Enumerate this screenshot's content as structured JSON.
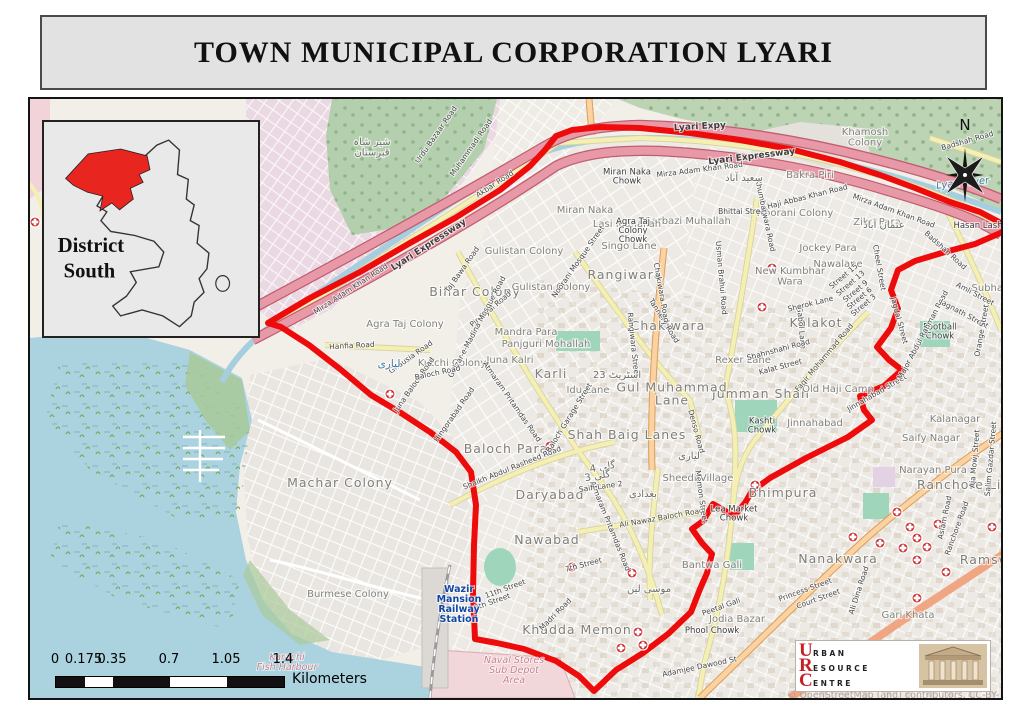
{
  "page": {
    "title": "TOWN MUNICIPAL CORPORATION LYARI"
  },
  "inset": {
    "label_line1": "District",
    "label_line2": "South"
  },
  "compass": {
    "label": "N"
  },
  "scalebar": {
    "ticks": [
      "0",
      "0.175",
      "0.35",
      "0.7",
      "1.05",
      "1.4"
    ],
    "unit": "Kilometers"
  },
  "attribution": "© OpenStreetMap (and) contributors, CC-BY-SA",
  "logo": {
    "letters": [
      "U",
      "R",
      "C"
    ],
    "words": [
      "RBAN",
      "ESOURCE",
      "ENTRE"
    ]
  },
  "colors": {
    "boundary_red": "#ee0b0b",
    "inset_highlight": "#e8251f",
    "water": "#aad3df",
    "expressway_fill": "#e899a7",
    "expressway_casing": "#c05e70",
    "road_yellow": "#f4efb2",
    "road_orange": "#fbd2a0",
    "poi_red": "#c8171c"
  },
  "map": {
    "labels": [
      {
        "t": "Miran Naka",
        "x": 585,
        "y": 213,
        "k": "a"
      },
      {
        "t": "Bihar Colony",
        "x": 475,
        "y": 296,
        "k": "A"
      },
      {
        "t": "Agra Taj Colony",
        "x": 405,
        "y": 327,
        "k": "a"
      },
      {
        "t": "Gulistan Colony",
        "x": 524,
        "y": 254,
        "k": "a"
      },
      {
        "t": "Gulistan Colony",
        "x": 551,
        "y": 290,
        "k": "a"
      },
      {
        "t": "Rangiwara",
        "x": 625,
        "y": 279,
        "k": "A"
      },
      {
        "t": "Chakiwara",
        "x": 668,
        "y": 330,
        "k": "A"
      },
      {
        "t": "Mandra Para",
        "x": 526,
        "y": 335,
        "k": "a"
      },
      {
        "t": "Panjguri Mohallah",
        "x": 546,
        "y": 347,
        "k": "a"
      },
      {
        "t": "Juna Kalri",
        "x": 510,
        "y": 363,
        "k": "a"
      },
      {
        "t": "Karli",
        "x": 551,
        "y": 378,
        "k": "A"
      },
      {
        "t": "Kutchi Colony",
        "x": 452,
        "y": 366,
        "k": "a"
      },
      {
        "t": "Singo Lane",
        "x": 629,
        "y": 249,
        "k": "a"
      },
      {
        "t": "Sarbazi Muhallah",
        "x": 688,
        "y": 224,
        "k": "a"
      },
      {
        "t": "Lasi Muhallah",
        "x": 627,
        "y": 227,
        "k": "a"
      },
      {
        "t": "Noorani Colony",
        "x": 795,
        "y": 216,
        "k": "a"
      },
      {
        "t": "Bakra Piri",
        "x": 810,
        "y": 178,
        "k": "a"
      },
      {
        "t": "Khamosh Colony",
        "x": 865,
        "y": 140,
        "k": "a",
        "lines": [
          "Khamosh",
          "Colony"
        ]
      },
      {
        "t": "Zikri Para",
        "x": 877,
        "y": 225,
        "k": "a"
      },
      {
        "t": "Jockey Para",
        "x": 828,
        "y": 251,
        "k": "a"
      },
      {
        "t": "Nawalane",
        "x": 838,
        "y": 267,
        "k": "a"
      },
      {
        "t": "New Kumbhar Wara",
        "x": 790,
        "y": 279,
        "k": "a",
        "lines": [
          "New Kumbhar",
          "Wara"
        ]
      },
      {
        "t": "Kalakot",
        "x": 816,
        "y": 327,
        "k": "A"
      },
      {
        "t": "Rexer Lane",
        "x": 743,
        "y": 363,
        "k": "a"
      },
      {
        "t": "Jumman Shah",
        "x": 761,
        "y": 398,
        "k": "A"
      },
      {
        "t": "Old Haji Camp",
        "x": 838,
        "y": 392,
        "k": "a"
      },
      {
        "t": "Gul Muhammad Lane",
        "x": 672,
        "y": 398,
        "k": "A",
        "lines": [
          "Gul Muhammad",
          "Lane"
        ]
      },
      {
        "t": "Shah Baig Lanes",
        "x": 627,
        "y": 439,
        "k": "A"
      },
      {
        "t": "Idu Lane",
        "x": 588,
        "y": 393,
        "k": "a"
      },
      {
        "t": "Baloch Para",
        "x": 506,
        "y": 453,
        "k": "A"
      },
      {
        "t": "Daryabad",
        "x": 550,
        "y": 499,
        "k": "A"
      },
      {
        "t": "Nawabad",
        "x": 547,
        "y": 544,
        "k": "A"
      },
      {
        "t": "Khadda Memon",
        "x": 577,
        "y": 634,
        "k": "A"
      },
      {
        "t": "Sheedi Village",
        "x": 698,
        "y": 481,
        "k": "a"
      },
      {
        "t": "Bhimpura",
        "x": 783,
        "y": 497,
        "k": "A"
      },
      {
        "t": "Bantwa Gali",
        "x": 712,
        "y": 568,
        "k": "a"
      },
      {
        "t": "Nanakwara",
        "x": 838,
        "y": 563,
        "k": "A"
      },
      {
        "t": "Saify Nagar",
        "x": 931,
        "y": 441,
        "k": "a"
      },
      {
        "t": "Kalanagar",
        "x": 955,
        "y": 422,
        "k": "a"
      },
      {
        "t": "Narayan Pura",
        "x": 933,
        "y": 473,
        "k": "a"
      },
      {
        "t": "Ranchore Line",
        "x": 968,
        "y": 489,
        "k": "A"
      },
      {
        "t": "Gari Khata",
        "x": 908,
        "y": 618,
        "k": "a"
      },
      {
        "t": "Jodia Bazar",
        "x": 737,
        "y": 622,
        "k": "a"
      },
      {
        "t": "Phool Chowk",
        "x": 712,
        "y": 633,
        "k": "c"
      },
      {
        "t": "Burmese Colony",
        "x": 348,
        "y": 597,
        "k": "a"
      },
      {
        "t": "Machar Colony",
        "x": 340,
        "y": 487,
        "k": "A"
      },
      {
        "t": "Subhash",
        "x": 993,
        "y": 291,
        "k": "a"
      },
      {
        "t": "Hasan Lash",
        "x": 978,
        "y": 228,
        "k": "c"
      },
      {
        "t": "Ramswami",
        "x": 998,
        "y": 564,
        "k": "A"
      },
      {
        "t": "Miran Naka Chowk",
        "x": 627,
        "y": 179,
        "k": "c",
        "lines": [
          "Miran Naka",
          "Chowk"
        ]
      },
      {
        "t": "Agra Taj Colony Chowk",
        "x": 633,
        "y": 233,
        "k": "c",
        "lines": [
          "Agra Taj",
          "Colony",
          "Chowk"
        ]
      },
      {
        "t": "Football Chowk",
        "x": 940,
        "y": 334,
        "k": "c",
        "lines": [
          "Football",
          "Chowk"
        ]
      },
      {
        "t": "Kashti Chowk",
        "x": 762,
        "y": 428,
        "k": "c",
        "lines": [
          "Kashti",
          "Chowk"
        ]
      },
      {
        "t": "Lea Market Chowk",
        "x": 734,
        "y": 516,
        "k": "c",
        "lines": [
          "Lea Market",
          "Chowk"
        ]
      },
      {
        "t": "Jinnahabad",
        "x": 815,
        "y": 426,
        "k": "a"
      },
      {
        "t": "Lyari Expy",
        "x": 700,
        "y": 129,
        "k": "R",
        "r": -3
      },
      {
        "t": "Lyari Expressway",
        "x": 752,
        "y": 159,
        "k": "R",
        "r": -7
      },
      {
        "t": "Mirza Adam Khan Road",
        "x": 700,
        "y": 172,
        "k": "r",
        "r": -7
      },
      {
        "t": "Mirza Adam Khan Road",
        "x": 893,
        "y": 213,
        "k": "r",
        "r": 20
      },
      {
        "t": "Mirza Adam Khan Road",
        "x": 352,
        "y": 291,
        "k": "r",
        "r": -33
      },
      {
        "t": "Lyari Expressway",
        "x": 430,
        "y": 247,
        "k": "R",
        "r": -33
      },
      {
        "t": "Akbar Road",
        "x": 496,
        "y": 186,
        "k": "r",
        "r": -33
      },
      {
        "t": "Muhammadi Road",
        "x": 473,
        "y": 149,
        "k": "r",
        "r": -55
      },
      {
        "t": "Urdu Bazaar Road",
        "x": 438,
        "y": 136,
        "k": "r",
        "r": -55
      },
      {
        "t": "Badshah Road",
        "x": 968,
        "y": 143,
        "k": "r",
        "r": -16
      },
      {
        "t": "Badshah Road",
        "x": 944,
        "y": 252,
        "k": "r",
        "r": 42
      },
      {
        "t": "Haji Abbas Khan Road",
        "x": 808,
        "y": 199,
        "k": "r",
        "r": -14
      },
      {
        "t": "Bhittai Street",
        "x": 743,
        "y": 214,
        "k": "r"
      },
      {
        "t": "Khumbarwara Road",
        "x": 763,
        "y": 216,
        "k": "r",
        "r": 78
      },
      {
        "t": "Tannery Road",
        "x": 662,
        "y": 322,
        "k": "r",
        "r": 58
      },
      {
        "t": "Chakiwara Road",
        "x": 659,
        "y": 293,
        "k": "r",
        "r": 80
      },
      {
        "t": "Rangiwara Street",
        "x": 631,
        "y": 345,
        "k": "r",
        "r": 84
      },
      {
        "t": "Denso Road",
        "x": 694,
        "y": 432,
        "k": "r",
        "r": 75
      },
      {
        "t": "Pir Siyal Road",
        "x": 492,
        "y": 311,
        "k": "r",
        "r": -40
      },
      {
        "t": "Gulzar-e-Madina Mosque Road",
        "x": 479,
        "y": 328,
        "k": "r",
        "r": -62
      },
      {
        "t": "Noorani Mosque Street",
        "x": 580,
        "y": 263,
        "k": "r",
        "r": -55
      },
      {
        "t": "Taj Bawa Road",
        "x": 464,
        "y": 271,
        "k": "r",
        "r": -55
      },
      {
        "t": "Ghausia Road",
        "x": 412,
        "y": 359,
        "k": "r",
        "r": -35
      },
      {
        "t": "Juna Baloch Road",
        "x": 416,
        "y": 386,
        "k": "r",
        "r": -55
      },
      {
        "t": "Baloch Road",
        "x": 438,
        "y": 375,
        "k": "r",
        "r": -12
      },
      {
        "t": "Hingorabad Road",
        "x": 456,
        "y": 416,
        "k": "r",
        "r": -55
      },
      {
        "t": "Atmaram Pritamdas Road",
        "x": 510,
        "y": 403,
        "k": "r",
        "r": 55
      },
      {
        "t": "Atmaram Pritamdas Road",
        "x": 608,
        "y": 527,
        "k": "r",
        "r": 68
      },
      {
        "t": "Shaikh Abdul Rasheed Road",
        "x": 513,
        "y": 470,
        "k": "r",
        "r": -22
      },
      {
        "t": "Ali Nawaz Baloch Road",
        "x": 662,
        "y": 520,
        "k": "r",
        "r": -10
      },
      {
        "t": "Baloch Garage Street",
        "x": 571,
        "y": 419,
        "k": "r",
        "r": -58
      },
      {
        "t": "Faqir Mohammad Road",
        "x": 826,
        "y": 359,
        "k": "r",
        "r": -50
      },
      {
        "t": "Gabol Lane",
        "x": 799,
        "y": 328,
        "k": "r",
        "r": 85
      },
      {
        "t": "Shahnshahi Road",
        "x": 779,
        "y": 352,
        "k": "r",
        "r": -15
      },
      {
        "t": "Kalat Street",
        "x": 781,
        "y": 369,
        "k": "r",
        "r": -15
      },
      {
        "t": "Jinnahabad Street",
        "x": 878,
        "y": 395,
        "k": "r",
        "r": -30
      },
      {
        "t": "Major Abdul Rahman Road",
        "x": 925,
        "y": 336,
        "k": "r",
        "r": -62
      },
      {
        "t": "Jagdal Street",
        "x": 897,
        "y": 321,
        "k": "r",
        "r": 75
      },
      {
        "t": "Cheel Street",
        "x": 877,
        "y": 268,
        "k": "r",
        "r": 80
      },
      {
        "t": "Jagnath Street",
        "x": 963,
        "y": 316,
        "k": "r",
        "r": 28
      },
      {
        "t": "Amli Street",
        "x": 974,
        "y": 296,
        "k": "r",
        "r": 28
      },
      {
        "t": "Orange Street",
        "x": 984,
        "y": 331,
        "k": "r",
        "r": -80
      },
      {
        "t": "Aslam Road",
        "x": 947,
        "y": 518,
        "k": "r",
        "r": -78
      },
      {
        "t": "Ranchore Road",
        "x": 959,
        "y": 529,
        "k": "r",
        "r": -70
      },
      {
        "t": "Aja Mowj Street",
        "x": 977,
        "y": 459,
        "k": "r",
        "r": -85
      },
      {
        "t": "Salim Gazdar Street",
        "x": 993,
        "y": 459,
        "k": "r",
        "r": -85
      },
      {
        "t": "Ali Dina Road",
        "x": 861,
        "y": 591,
        "k": "r",
        "r": -72
      },
      {
        "t": "Princess Street",
        "x": 806,
        "y": 592,
        "k": "r",
        "r": -20
      },
      {
        "t": "Court Street",
        "x": 819,
        "y": 601,
        "k": "r",
        "r": -20
      },
      {
        "t": "Adamjee Dawood St",
        "x": 700,
        "y": 669,
        "k": "r",
        "r": -12
      },
      {
        "t": "Peetal Gali",
        "x": 722,
        "y": 609,
        "k": "r",
        "r": -20
      },
      {
        "t": "Madri Road",
        "x": 557,
        "y": 616,
        "k": "r",
        "r": -45
      },
      {
        "t": "7th Street",
        "x": 584,
        "y": 567,
        "k": "r",
        "r": -15
      },
      {
        "t": "11th Street",
        "x": 506,
        "y": 591,
        "k": "r",
        "r": -20
      },
      {
        "t": "8th Street",
        "x": 493,
        "y": 604,
        "k": "r",
        "r": -20
      },
      {
        "t": "Street 15",
        "x": 845,
        "y": 278,
        "k": "r",
        "r": -40
      },
      {
        "t": "Street 13",
        "x": 852,
        "y": 285,
        "k": "r",
        "r": -40
      },
      {
        "t": "Street 9",
        "x": 857,
        "y": 293,
        "k": "r",
        "r": -40
      },
      {
        "t": "Street 6",
        "x": 861,
        "y": 300,
        "k": "r",
        "r": -40
      },
      {
        "t": "Street 3",
        "x": 865,
        "y": 307,
        "k": "r",
        "r": -40
      },
      {
        "t": "Sherok Lane",
        "x": 811,
        "y": 306,
        "k": "r",
        "r": -14
      },
      {
        "t": "Hanfia Road",
        "x": 352,
        "y": 348,
        "k": "r",
        "r": -3
      },
      {
        "t": "Saifi Lane 2",
        "x": 601,
        "y": 489,
        "k": "r",
        "r": -8
      },
      {
        "t": "Memon Street",
        "x": 699,
        "y": 497,
        "k": "r",
        "r": 82
      },
      {
        "t": "Usman Brahui Road",
        "x": 719,
        "y": 278,
        "k": "r",
        "r": 85
      },
      {
        "t": "Lyari River",
        "x": 963,
        "y": 186,
        "k": "w",
        "r": -6
      },
      {
        "t": "Karachi Fish Harbour",
        "x": 287,
        "y": 665,
        "k": "p",
        "lines": [
          "Karachi",
          "Fish Harbour"
        ]
      },
      {
        "t": "Naval Stores Sub Depot Area",
        "x": 514,
        "y": 673,
        "k": "p",
        "lines": [
          "Naval Stores",
          "Sub Depot",
          "Area"
        ]
      },
      {
        "t": "Wazir Mansion Railway Station",
        "x": 459,
        "y": 607,
        "k": "s",
        "lines": [
          "Wazir",
          "Mansion",
          "Railway",
          "Station"
        ]
      },
      {
        "t": "شیر شاہ قبرستان",
        "x": 372,
        "y": 150,
        "k": "u",
        "lines": [
          "شیر شاہ",
          "قبرستان"
        ]
      },
      {
        "t": "سعید آباد",
        "x": 744,
        "y": 181,
        "k": "u"
      },
      {
        "t": "عثمان آباد",
        "x": 884,
        "y": 228,
        "k": "u"
      },
      {
        "t": "لیاری",
        "x": 389,
        "y": 367,
        "k": "b"
      },
      {
        "t": "لیاری",
        "x": 689,
        "y": 459,
        "k": "u"
      },
      {
        "t": "بغدادی",
        "x": 643,
        "y": 497,
        "k": "u"
      },
      {
        "t": "موسی لین",
        "x": 649,
        "y": 592,
        "k": "u"
      },
      {
        "t": "23 اسٹریٹ",
        "x": 617,
        "y": 378,
        "k": "u"
      },
      {
        "t": "گلی 4",
        "x": 603,
        "y": 470,
        "k": "u",
        "r": -10
      },
      {
        "t": "گلی 3",
        "x": 598,
        "y": 479,
        "k": "u",
        "r": -10
      }
    ],
    "pois": [
      [
        35,
        222
      ],
      [
        390,
        394
      ],
      [
        550,
        446
      ],
      [
        772,
        268
      ],
      [
        762,
        307
      ],
      [
        572,
        567
      ],
      [
        632,
        573
      ],
      [
        638,
        632
      ],
      [
        621,
        648
      ],
      [
        643,
        645
      ],
      [
        755,
        485
      ],
      [
        880,
        543
      ],
      [
        897,
        512
      ],
      [
        903,
        548
      ],
      [
        910,
        527
      ],
      [
        917,
        538
      ],
      [
        927,
        547
      ],
      [
        938,
        524
      ],
      [
        917,
        560
      ],
      [
        946,
        572
      ],
      [
        917,
        598
      ],
      [
        992,
        527
      ],
      [
        853,
        537
      ]
    ]
  }
}
